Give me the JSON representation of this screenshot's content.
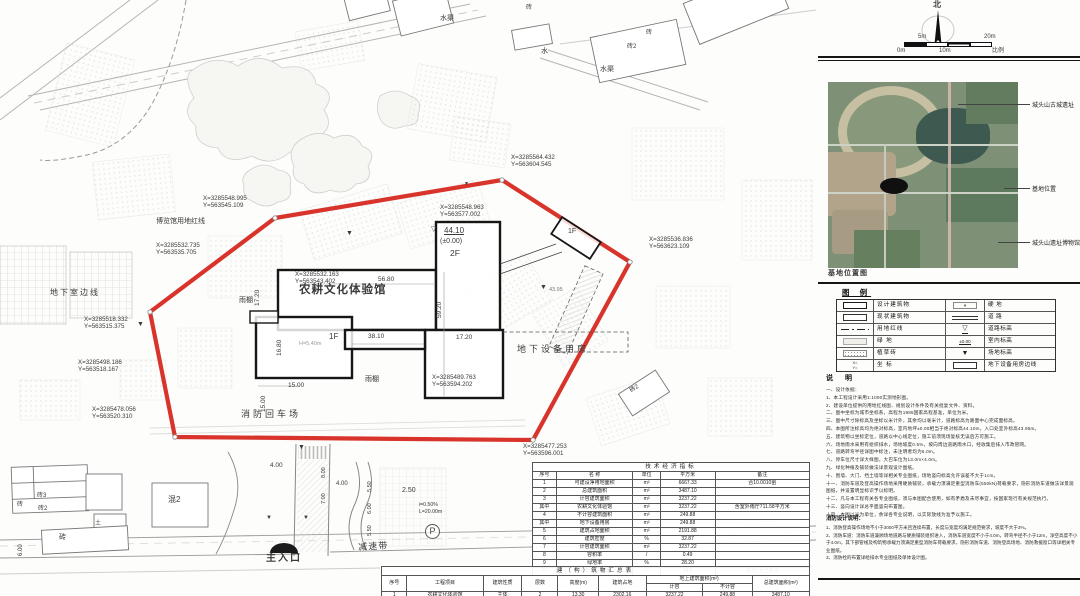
{
  "colors": {
    "boundary_red": "#d8342c",
    "ink": "#1a1a1a",
    "dim_text": "#555555",
    "photo_green": "#7e9177"
  },
  "plan": {
    "labels": [
      {
        "n": "coord-label",
        "t": "X=3285548.995\nY=563545.109",
        "x": 203,
        "y": 195,
        "s": 6.2
      },
      {
        "n": "coord-label",
        "t": "X=3285532.735\nY=563535.705",
        "x": 156,
        "y": 242,
        "s": 6.2
      },
      {
        "n": "coord-label",
        "t": "X=3285564.432\nY=563604.545",
        "x": 511,
        "y": 154,
        "s": 6.2
      },
      {
        "n": "coord-label",
        "t": "X=3285548.963\nY=563577.002",
        "x": 440,
        "y": 204,
        "s": 6.2
      },
      {
        "n": "coord-label",
        "t": "X=3285536.836\nY=563623.109",
        "x": 649,
        "y": 236,
        "s": 6.2
      },
      {
        "n": "coord-label",
        "t": "X=3285518.332\nY=563515.375",
        "x": 84,
        "y": 316,
        "s": 6.2
      },
      {
        "n": "coord-label",
        "t": "X=3285498.186\nY=563518.167",
        "x": 78,
        "y": 359,
        "s": 6.2
      },
      {
        "n": "coord-label",
        "t": "X=3285478.056\nY=563520.310",
        "x": 92,
        "y": 406,
        "s": 6.2
      },
      {
        "n": "coord-label",
        "t": "X=3285489.763\nY=563594.202",
        "x": 432,
        "y": 374,
        "s": 6.2
      },
      {
        "n": "coord-label",
        "t": "X=3285477.253\nY=563596.001",
        "x": 523,
        "y": 443,
        "s": 6.2
      },
      {
        "n": "coord-label",
        "t": "X=3285532.163\nY=563543.402",
        "x": 295,
        "y": 271,
        "s": 6.2
      },
      {
        "n": "redline-label",
        "t": "博览馆用地红线",
        "x": 156,
        "y": 218,
        "s": 7
      },
      {
        "n": "basement-line-label",
        "t": "地下室边线",
        "x": 50,
        "y": 288,
        "s": 8,
        "ls": 2
      },
      {
        "n": "building-name",
        "t": "农耕文化体验馆",
        "x": 299,
        "y": 284,
        "s": 11.5,
        "b": 1,
        "ls": 1
      },
      {
        "n": "equipment-room-label",
        "t": "地下设备用房",
        "x": 517,
        "y": 344,
        "s": 9,
        "ls": 3
      },
      {
        "n": "fire-turnaround-label",
        "t": "消防回车场",
        "x": 241,
        "y": 409,
        "s": 9,
        "ls": 3
      },
      {
        "n": "canopy-label",
        "t": "雨棚",
        "x": 365,
        "y": 376,
        "s": 7
      },
      {
        "n": "canopy-label",
        "t": "雨棚",
        "x": 239,
        "y": 297,
        "s": 7
      },
      {
        "n": "main-entrance-label",
        "t": "主入口",
        "x": 266,
        "y": 553,
        "s": 10,
        "b": 1,
        "ls": 2
      },
      {
        "n": "speed-bump-label",
        "t": "减速带",
        "x": 358,
        "y": 542,
        "s": 9,
        "ls": 1,
        "rot": -3
      },
      {
        "n": "water-channel-label",
        "t": "水渠",
        "x": 440,
        "y": 15,
        "s": 7
      },
      {
        "n": "water-label",
        "t": "水",
        "x": 541,
        "y": 48,
        "s": 7
      },
      {
        "n": "water-channel-label",
        "t": "水渠",
        "x": 600,
        "y": 66,
        "s": 7
      },
      {
        "n": "bldg-label",
        "t": "砖",
        "x": 526,
        "y": 5,
        "s": 6
      },
      {
        "n": "bldg-label",
        "t": "砖2",
        "x": 627,
        "y": 44,
        "s": 6
      },
      {
        "n": "bldg-label",
        "t": "砖",
        "x": 646,
        "y": 30,
        "s": 6
      },
      {
        "n": "bldg-label",
        "t": "砖3",
        "x": 37,
        "y": 493,
        "s": 6
      },
      {
        "n": "bldg-label",
        "t": "砖2",
        "x": 38,
        "y": 506,
        "s": 6
      },
      {
        "n": "bldg-label",
        "t": "砖",
        "x": 17,
        "y": 502,
        "s": 6
      },
      {
        "n": "bldg-label",
        "t": "砖",
        "x": 59,
        "y": 534,
        "s": 7
      },
      {
        "n": "bldg-label",
        "t": "土",
        "x": 95,
        "y": 521,
        "s": 6
      },
      {
        "n": "bldg-label",
        "t": "混2",
        "x": 168,
        "y": 495,
        "s": 8
      },
      {
        "n": "bldg-label",
        "t": "砖2",
        "x": 629,
        "y": 389,
        "s": 6,
        "rot": -33
      },
      {
        "n": "dim-label",
        "t": "56.80",
        "x": 378,
        "y": 276,
        "s": 6.5
      },
      {
        "n": "dim-label",
        "t": "38.10",
        "x": 368,
        "y": 333,
        "s": 6.5
      },
      {
        "n": "dim-label",
        "t": "17.20",
        "x": 456,
        "y": 334,
        "s": 6.5
      },
      {
        "n": "dim-label",
        "t": "15.00",
        "x": 288,
        "y": 382,
        "s": 6.5
      },
      {
        "n": "dim-label",
        "t": "15.00",
        "x": 260,
        "y": 412,
        "s": 6.5,
        "rot": -90
      },
      {
        "n": "dim-label",
        "t": "17.20",
        "x": 254,
        "y": 306,
        "s": 6.5,
        "rot": -90
      },
      {
        "n": "dim-label",
        "t": "16.80",
        "x": 276,
        "y": 356,
        "s": 6.5,
        "rot": -90
      },
      {
        "n": "dim-label",
        "t": "59.20",
        "x": 436,
        "y": 318,
        "s": 6.5,
        "rot": -90
      },
      {
        "n": "floor-label",
        "t": "1F",
        "x": 329,
        "y": 332,
        "s": 8
      },
      {
        "n": "floor-label",
        "t": "1F",
        "x": 568,
        "y": 228,
        "s": 7
      },
      {
        "n": "floor-label",
        "t": "2F",
        "x": 450,
        "y": 248,
        "s": 8.5
      },
      {
        "n": "elev-label",
        "t": "44.10",
        "x": 444,
        "y": 226,
        "s": 8,
        "u": 1
      },
      {
        "n": "elev-mark",
        "t": "▽",
        "x": 431,
        "y": 226,
        "s": 7
      },
      {
        "n": "elev-label",
        "t": "(±0.00)",
        "x": 440,
        "y": 238,
        "s": 7
      },
      {
        "n": "dim-label",
        "t": "H=5.40m",
        "x": 299,
        "y": 341,
        "s": 5.5,
        "c": "#9a9a9a"
      },
      {
        "n": "elev-label",
        "t": "43.95",
        "x": 549,
        "y": 287,
        "s": 5.5,
        "c": "#777777"
      },
      {
        "n": "dim-label",
        "t": "4.00",
        "x": 270,
        "y": 462,
        "s": 6.5
      },
      {
        "n": "dim-label",
        "t": "4.00",
        "x": 336,
        "y": 481,
        "s": 6
      },
      {
        "n": "dim-label",
        "t": "2.50",
        "x": 402,
        "y": 487,
        "s": 7
      },
      {
        "n": "dim-label",
        "t": "i=0.50%",
        "x": 419,
        "y": 502,
        "s": 5.2
      },
      {
        "n": "dim-label",
        "t": "L=20.00m",
        "x": 419,
        "y": 509,
        "s": 5.2
      },
      {
        "n": "dim-label",
        "t": "6.00",
        "x": 18,
        "y": 556,
        "s": 6,
        "rot": -90
      },
      {
        "n": "dim-label",
        "t": "8.00",
        "x": 321,
        "y": 478,
        "s": 5.5,
        "rot": -90
      },
      {
        "n": "dim-label",
        "t": "7.00",
        "x": 321,
        "y": 504,
        "s": 5.5,
        "rot": -90
      },
      {
        "n": "dim-label",
        "t": "5.50",
        "x": 367,
        "y": 492,
        "s": 5.5,
        "rot": -90
      },
      {
        "n": "dim-label",
        "t": "6.00",
        "x": 367,
        "y": 514,
        "s": 5.5,
        "rot": -90
      },
      {
        "n": "dim-label",
        "t": "5.50",
        "x": 367,
        "y": 536,
        "s": 5.5,
        "rot": -90
      },
      {
        "n": "level-marker",
        "t": "▼",
        "x": 346,
        "y": 230,
        "s": 7
      },
      {
        "n": "level-marker",
        "t": "▼",
        "x": 137,
        "y": 321,
        "s": 7
      },
      {
        "n": "level-marker",
        "t": "▼",
        "x": 540,
        "y": 284,
        "s": 7
      },
      {
        "n": "level-marker",
        "t": "▼",
        "x": 298,
        "y": 444,
        "s": 7
      },
      {
        "n": "level-marker",
        "t": "▼",
        "x": 464,
        "y": 182,
        "s": 5
      },
      {
        "n": "level-marker",
        "t": "▼",
        "x": 266,
        "y": 515,
        "s": 6
      },
      {
        "n": "level-marker",
        "t": "▼",
        "x": 303,
        "y": 515,
        "s": 6
      },
      {
        "n": "parking-label",
        "t": "P",
        "x": 425,
        "y": 524,
        "s": 9
      },
      {
        "n": "north-label",
        "t": "北",
        "x": 933,
        "y": 0,
        "s": 8,
        "b": 1
      },
      {
        "n": "scale-tick",
        "t": "0m",
        "x": 897,
        "y": 48,
        "s": 6
      },
      {
        "n": "scale-tick",
        "t": "5m",
        "x": 918,
        "y": 34,
        "s": 6
      },
      {
        "n": "scale-tick",
        "t": "10m",
        "x": 939,
        "y": 48,
        "s": 6
      },
      {
        "n": "scale-tick",
        "t": "20m",
        "x": 984,
        "y": 34,
        "s": 6
      },
      {
        "n": "scale-caption",
        "t": "比例",
        "x": 992,
        "y": 48,
        "s": 6
      },
      {
        "n": "photo-caption",
        "t": "基地位置图",
        "x": 828,
        "y": 270,
        "s": 7,
        "b": 1,
        "ls": 1
      }
    ]
  },
  "panel": {
    "photo_callouts": [
      {
        "t": "城头山古城遗址",
        "y": 100,
        "x1": 958
      },
      {
        "t": "基地位置",
        "y": 184,
        "x1": 1004
      },
      {
        "t": "城头山遗址博物馆",
        "y": 238,
        "x1": 998
      }
    ],
    "legend": {
      "title": "图 例",
      "left": [
        {
          "sym": "design",
          "label": "设计建筑物"
        },
        {
          "sym": "exist",
          "label": "现状建筑物"
        },
        {
          "sym": "redline",
          "label": "用地红线"
        },
        {
          "sym": "green",
          "label": "绿  地"
        },
        {
          "sym": "grassbrick",
          "label": "植草砖"
        },
        {
          "sym": "coord",
          "label": "坐  标"
        }
      ],
      "right": [
        {
          "sym": "hard",
          "label": "硬  地"
        },
        {
          "sym": "road",
          "label": "道  路"
        },
        {
          "sym": "roadlevel",
          "label": "道路标高"
        },
        {
          "sym": "indoor",
          "label": "室内标高"
        },
        {
          "sym": "sitelevel",
          "label": "场地标高"
        },
        {
          "sym": "basement",
          "label": "地下设备用房边线"
        }
      ],
      "sym_text": {
        "coord": "X=\nY=",
        "roadlevel": "▽",
        "indoor": "±0.00",
        "sitelevel": "▼"
      }
    },
    "notes": {
      "title": "说  明",
      "lines": [
        "一、设计依据：",
        "1、本工程设计采用1:1000实测地形图。",
        "2、建设单位提供的用地红线图、规划设计条件及有关批复文件、资料。",
        "二、图中坐标为城市坐标系，高程为1985国家高程基准，单位为米。",
        "三、图中尺寸除标高及坐标以米计外，其余均以毫米计，道路标高为路面中心完成面标高。",
        "四、本图所注标高均为绝对标高，室内地坪±0.00相当于绝对标高44.10m，入口处室外标高43.95m。",
        "五、建筑物以坐标定位，道路以中心线定位，施工前须现场复核无误后方可施工。",
        "六、场地雨水采用有组织排水，场地坡度0.5%，坡向周边道路雨水口，经收集后排入市政管网。",
        "七、道路转弯半径详图中标注，未注明者均为6.0m。",
        "八、停车位尺寸详大样图，大巴车位为13.0m×4.0m。",
        "九、绿化种植及铺装做法详景观设计图纸。",
        "十、围墙、大门、挡土墙等详相关专业图纸，场地竖向标高允许误差不大于1cm。",
        "十一、消防车道及登高操作场地采用硬质铺装，承载力须满足重型消防车(550kN)荷载要求，隐形消防车道做法详景观图纸，并设置明显标识予以标明。",
        "十二、凡与本工程有关各专业图纸，须与本图配合使用，如有矛盾及未尽事宜，按国家现行有关规范执行。",
        "十三、竖向设计详总平面竖向布置图。",
        "十四、本图以米为单位，余详各专业说明，以实际放线为准予以施工。"
      ]
    },
    "notes2": {
      "title": "消防设计说明：",
      "lines": [
        "1、消防登高操作场地不小于3000平方米且连续布置，长度与宽度均满足规范要求，坡度不大于3%。",
        "2、消防车道：消防车道兼顾场地道路与硬质铺装组织进入，消防车道宽度不小于4.0m，转弯半径不小于12m，净空高度不小于4.0m，其下部管线及构筑物承载力须满足重型消防车荷载要求，隐形消防车道、消防登高场地、消防救援窗口等详相关专业图纸。",
        "3、消防栓的布置详给排水专业图纸及单体设计图。"
      ]
    }
  },
  "tables": {
    "tech": {
      "title": "技术经济指标",
      "headers": [
        "序号",
        "名  称",
        "单位",
        "平方米",
        "备注"
      ],
      "rows": [
        [
          "1",
          "可建设净用地面积",
          "m²",
          "6667.33",
          "合10.0010亩"
        ],
        [
          "2",
          "总建筑面积",
          "m²",
          "3487.10",
          ""
        ],
        [
          "3",
          "计容建筑面积",
          "m²",
          "3237.22",
          ""
        ],
        [
          "其中",
          "农耕文化体验馆",
          "m²",
          "3237.22",
          "含室外雨厅711.58平方米"
        ],
        [
          "4",
          "不计容建筑面积",
          "m²",
          "249.88",
          ""
        ],
        [
          "其中",
          "地下设备用房",
          "m²",
          "249.88",
          ""
        ],
        [
          "5",
          "建筑占地面积",
          "m²",
          "2191.88",
          ""
        ],
        [
          "6",
          "建筑密度",
          "%",
          "32.87",
          ""
        ],
        [
          "7",
          "计容建筑面积",
          "m²",
          "3237.22",
          ""
        ],
        [
          "8",
          "容积率",
          "/",
          "0.49",
          ""
        ],
        [
          "9",
          "绿地率",
          "%",
          "28.20",
          ""
        ],
        [
          "10",
          "地面停车车位",
          "/",
          "14.9",
          "含3个大巴车位"
        ]
      ]
    },
    "buildings": {
      "title": "建（构）筑物汇总表",
      "head_row1": [
        "序号",
        "工程项目",
        "建筑性质",
        "层数",
        "高度(m)",
        "建筑占地",
        "地上建筑面积(m²)",
        "总建筑面积(m²)"
      ],
      "head_row2": [
        "计容",
        "不计容"
      ],
      "rows": [
        [
          "1",
          "农耕文化体验馆",
          "主体",
          "2",
          "13.30",
          "2302.16",
          "3237.22",
          "249.88",
          "3487.10"
        ],
        [
          "",
          "合计",
          "/",
          "/",
          "",
          "2191.88",
          "3237.22",
          "249.88",
          "3487.10"
        ]
      ]
    }
  }
}
